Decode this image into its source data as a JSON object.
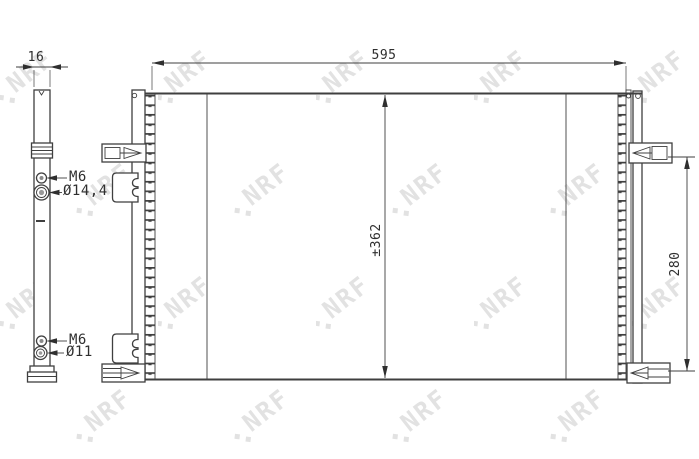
{
  "drawing": {
    "watermark": "NRF",
    "dimensions": {
      "overall_width": "595",
      "side_depth": "16",
      "core_height": "±362",
      "connector_spacing": "280"
    },
    "ports": {
      "upper_thread": "M6",
      "upper_pipe_diameter": "Ø14,4",
      "lower_thread": "M6",
      "lower_pipe_diameter": "Ø11"
    },
    "colors": {
      "line": "#3f3f3f",
      "fin": "#969696",
      "watermark": "#e2e2e2",
      "background": "#ffffff"
    }
  }
}
